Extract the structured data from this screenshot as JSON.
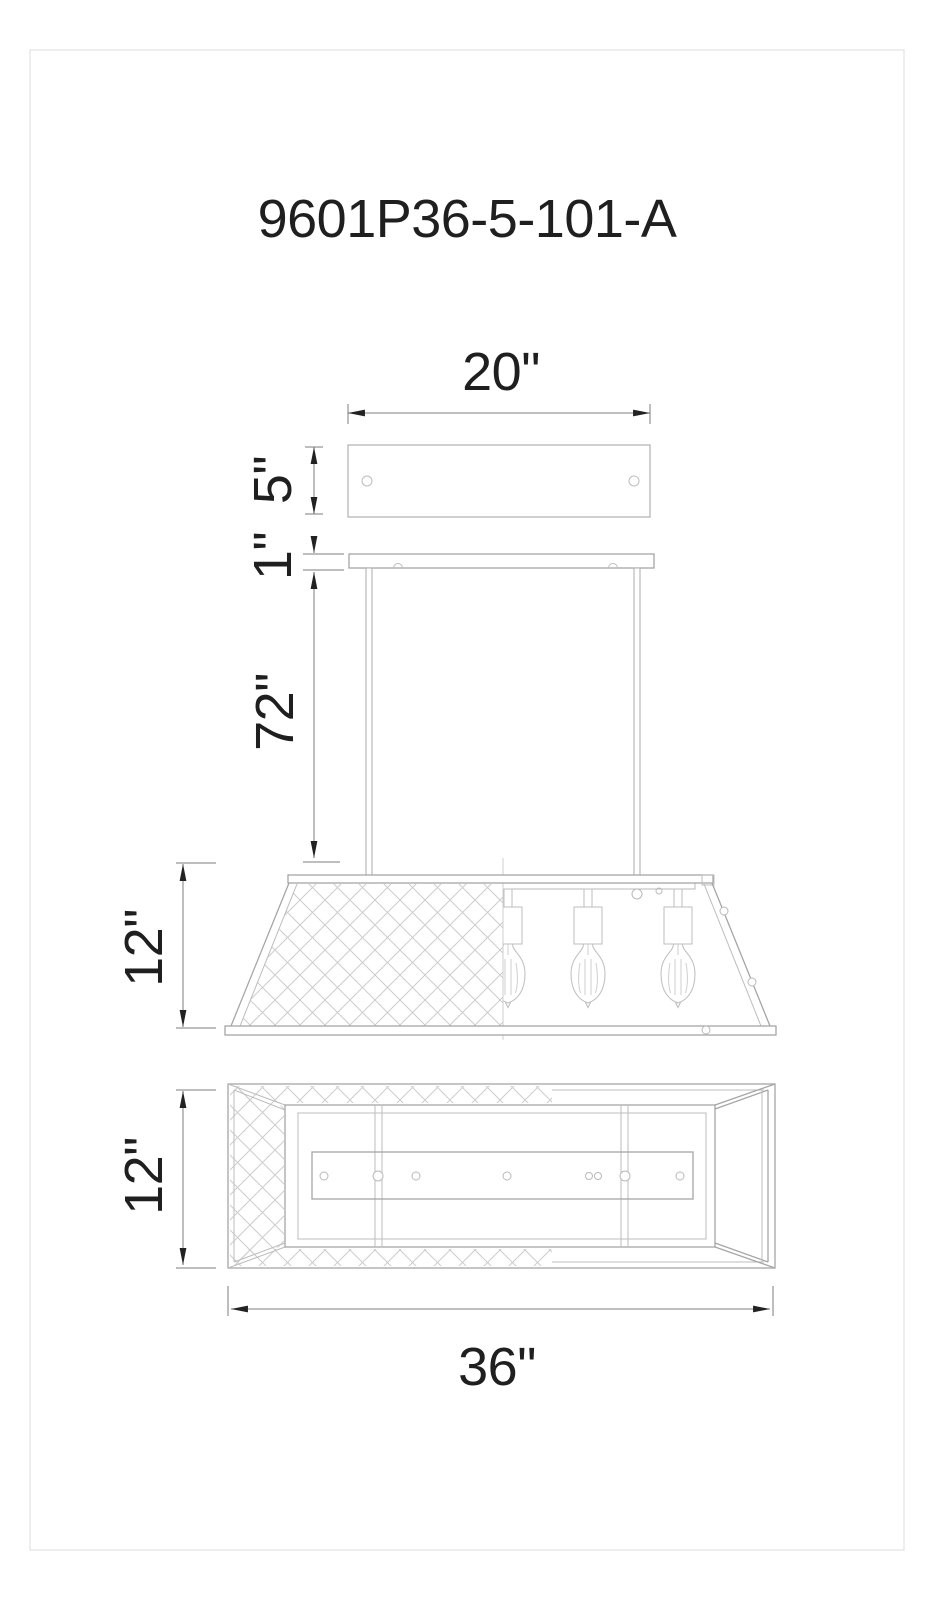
{
  "page": {
    "width": 935,
    "height": 1600,
    "background": "#ffffff",
    "frame_color": "#e8e8e8"
  },
  "title": {
    "text": "9601P36-5-101-A"
  },
  "drawing": {
    "type": "lighting-fixture-dimension-diagram",
    "product": "5-light linear island pendant with lattice mesh shade and Edison bulbs",
    "views": {
      "canopy_top": "rectangular ceiling canopy with two mounting screw holes",
      "canopy_side": "canopy profile with two hanger rods",
      "fixture_side": "trapezoid shade, left half lattice mesh, right half open showing Edison bulbs",
      "fixture_bottom": "bottom view with mesh border and center mounting bar with holes"
    },
    "dimensions": {
      "canopy_width": "20\"",
      "canopy_depth": "5\"",
      "canopy_thickness": "1\"",
      "rod_drop": "72\"",
      "shade_height": "12\"",
      "body_height": "12\"",
      "fixture_length": "36\""
    },
    "colors": {
      "object_line": "#a6a6a6",
      "light_line": "#bdbdbd",
      "mesh_line": "#cdcdcd",
      "dimension_line": "#7d7d7d",
      "text": "#1f1f1f"
    }
  }
}
